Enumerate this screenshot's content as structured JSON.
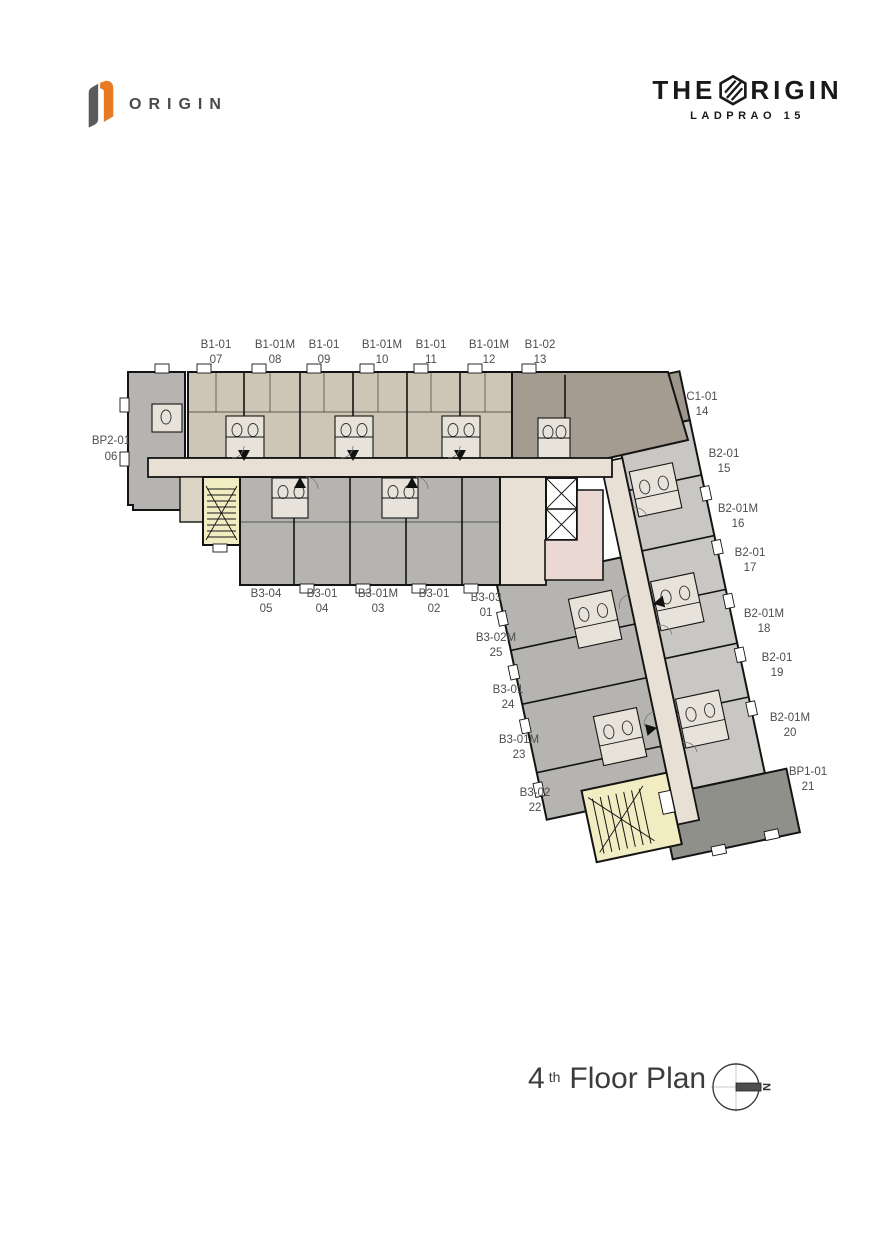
{
  "header": {
    "logo_text": "ORIGIN",
    "brand_the": "THE",
    "brand_rigin": "RIGIN",
    "brand_subtitle": "LADPRAO 15"
  },
  "footer": {
    "floor_number": "4",
    "floor_ordinal": "th",
    "floor_text": "Floor Plan",
    "compass_letter": "N"
  },
  "units": [
    {
      "code": "B1-01",
      "number": "07"
    },
    {
      "code": "B1-01M",
      "number": "08"
    },
    {
      "code": "B1-01",
      "number": "09"
    },
    {
      "code": "B1-01M",
      "number": "10"
    },
    {
      "code": "B1-01",
      "number": "11"
    },
    {
      "code": "B1-01M",
      "number": "12"
    },
    {
      "code": "B1-02",
      "number": "13"
    },
    {
      "code": "BP2-01",
      "number": "06"
    },
    {
      "code": "B3-04",
      "number": "05"
    },
    {
      "code": "B3-01",
      "number": "04"
    },
    {
      "code": "B3-01M",
      "number": "03"
    },
    {
      "code": "B3-01",
      "number": "02"
    },
    {
      "code": "B3-03",
      "number": "01"
    },
    {
      "code": "C1-01",
      "number": "14"
    },
    {
      "code": "B2-01",
      "number": "15"
    },
    {
      "code": "B2-01M",
      "number": "16"
    },
    {
      "code": "B2-01",
      "number": "17"
    },
    {
      "code": "B2-01M",
      "number": "18"
    },
    {
      "code": "B2-01",
      "number": "19"
    },
    {
      "code": "B2-01M",
      "number": "20"
    },
    {
      "code": "BP1-01",
      "number": "21"
    },
    {
      "code": "B3-02M",
      "number": "25"
    },
    {
      "code": "B3-01",
      "number": "24"
    },
    {
      "code": "B3-01M",
      "number": "23"
    },
    {
      "code": "B3-02",
      "number": "22"
    }
  ],
  "colors": {
    "accent_orange": "#e87a24",
    "wall": "#141414",
    "unit_beige": "#cdc5b5",
    "unit_gray": "#b5b4b0",
    "unit_light_gray": "#c8c7c3",
    "unit_dark_tan": "#a49c91",
    "unit_dark": "#9c958b",
    "unit_darkest": "#8f9089",
    "corridor_cream": "#e8e0d4",
    "stair_yellow": "#f2ecc2",
    "service_pink": "#ead9d3"
  }
}
